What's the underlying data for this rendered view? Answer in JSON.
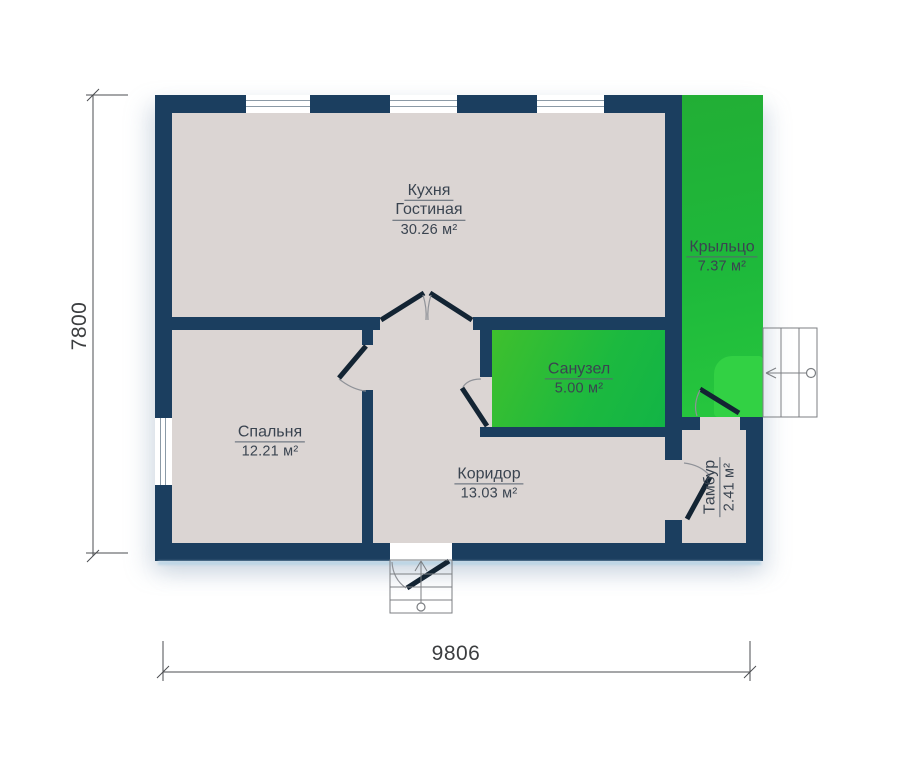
{
  "plan": {
    "type": "floor-plan",
    "rooms": {
      "kitchen": {
        "name_line1": "Кухня",
        "name_line2": "Гостиная",
        "area": "30.26 м²"
      },
      "bedroom": {
        "name": "Спальня",
        "area": "12.21 м²"
      },
      "bathroom": {
        "name": "Санузел",
        "area": "5.00 м²"
      },
      "corridor": {
        "name": "Коридор",
        "area": "13.03 м²"
      },
      "vestibule": {
        "name": "Тамбур",
        "area": "2.41 м²"
      },
      "porch": {
        "name": "Крыльцо",
        "area": "7.37 м²"
      }
    },
    "dimensions": {
      "overall_width": "9806",
      "overall_height": "7800"
    }
  },
  "colors": {
    "wall": "#1b3e5f",
    "floor": "#dbd5d3",
    "room_green": "#1eb93b",
    "door": "#132433",
    "label": "#3a4450"
  }
}
